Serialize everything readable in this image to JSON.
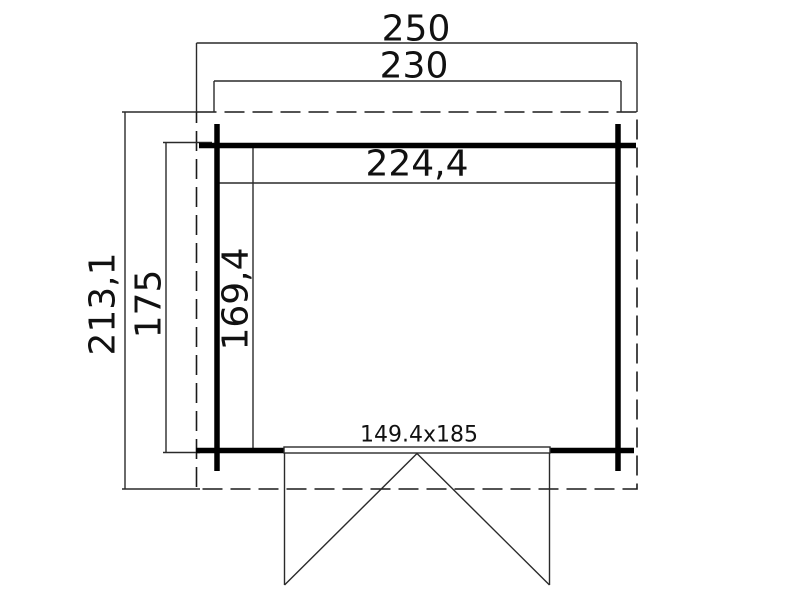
{
  "drawing": {
    "type": "floor-plan",
    "background_color": "#ffffff",
    "line_color": "#000000",
    "labels": {
      "overall_width": "250",
      "wall_outer_width": "230",
      "interior_width": "224,4",
      "overall_depth": "213,1",
      "wall_outer_depth": "175",
      "interior_depth": "169,4",
      "door_size": "149.4x185"
    },
    "dimensions_cm": {
      "overall_width": 250,
      "wall_outer_width": 230,
      "interior_width": 224.4,
      "overall_depth": 213.1,
      "wall_outer_depth": 175,
      "interior_depth": 169.4,
      "door_width": 149.4,
      "door_height": 185
    }
  }
}
